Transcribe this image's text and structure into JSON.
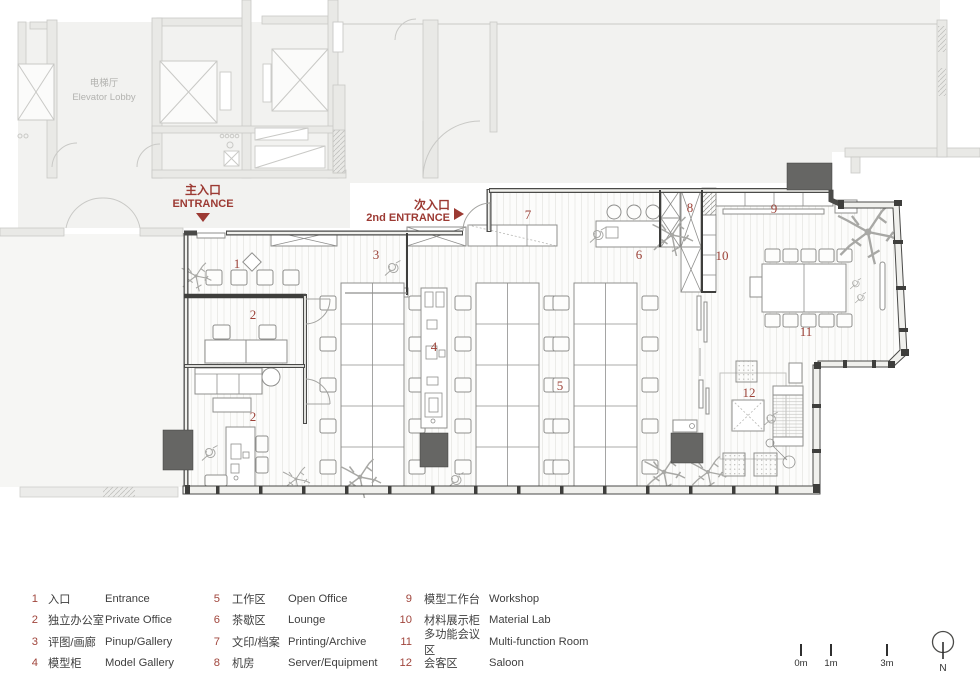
{
  "plan": {
    "context": {
      "elevator_lobby": {
        "zh": "电梯厅",
        "en": "Elevator Lobby"
      }
    },
    "entrances": {
      "main": {
        "zh": "主入口",
        "en": "ENTRANCE"
      },
      "second": {
        "zh": "次入口",
        "en": "2nd ENTRANCE"
      }
    },
    "room_labels": [
      "1",
      "2",
      "2",
      "3",
      "4",
      "5",
      "6",
      "7",
      "8",
      "9",
      "10",
      "11",
      "12"
    ]
  },
  "legend": {
    "columns": [
      {
        "items": [
          {
            "num": "1",
            "zh": "入口",
            "en": "Entrance"
          },
          {
            "num": "2",
            "zh": "独立办公室",
            "en": "Private Office"
          },
          {
            "num": "3",
            "zh": "评图/画廊",
            "en": "Pinup/Gallery"
          },
          {
            "num": "4",
            "zh": "模型柜",
            "en": "Model Gallery"
          }
        ]
      },
      {
        "items": [
          {
            "num": "5",
            "zh": "工作区",
            "en": "Open Office"
          },
          {
            "num": "6",
            "zh": "茶歇区",
            "en": "Lounge"
          },
          {
            "num": "7",
            "zh": "文印/档案",
            "en": "Printing/Archive"
          },
          {
            "num": "8",
            "zh": "机房",
            "en": "Server/Equipment"
          }
        ]
      },
      {
        "items": [
          {
            "num": "9",
            "zh": "模型工作台",
            "en": "Workshop"
          },
          {
            "num": "10",
            "zh": "材料展示柜",
            "en": "Material Lab"
          },
          {
            "num": "11",
            "zh": "多功能会议区",
            "en": "Multi-function Room"
          },
          {
            "num": "12",
            "zh": "会客区",
            "en": "Saloon"
          }
        ]
      }
    ]
  },
  "scale_bar": {
    "ticks": [
      "0m",
      "1m",
      "3m"
    ]
  },
  "north_indicator": {
    "label": "N"
  },
  "colors": {
    "accent": "#9c3a33",
    "wall": "#3e3e3c",
    "column": "#666664",
    "context": "#c9c9c6"
  }
}
